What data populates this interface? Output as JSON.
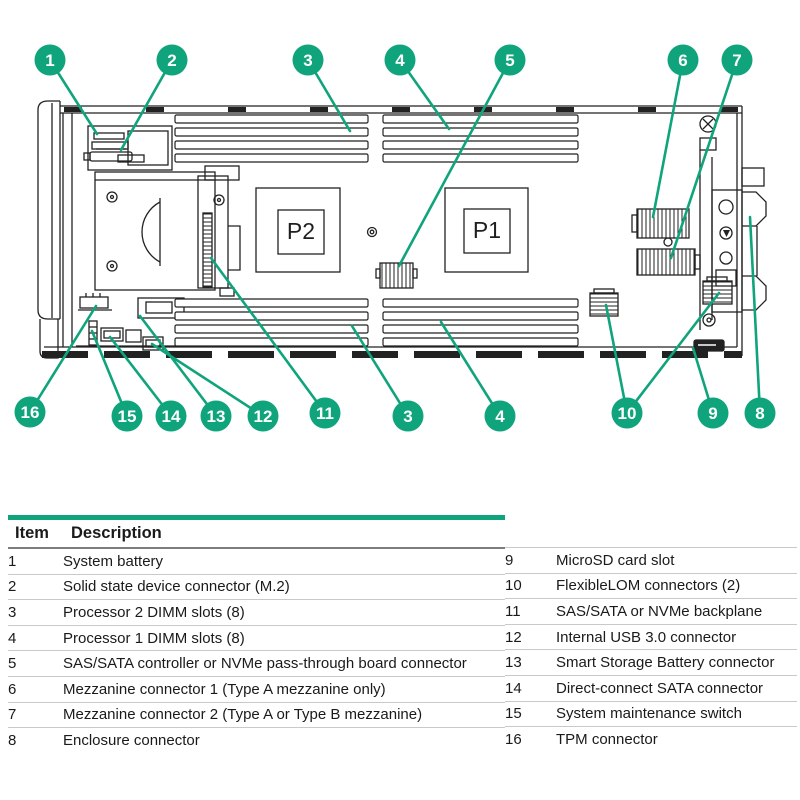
{
  "colors": {
    "green": "#10A47C",
    "line": "#222222",
    "row_rule": "#c9c9c9",
    "header_rule": "#7d7d7d"
  },
  "diagram": {
    "board_labels": {
      "p2": "P2",
      "p1": "P1"
    },
    "callouts": [
      {
        "label": "1",
        "x": 50,
        "y": 60,
        "targets": [
          [
            97,
            134
          ]
        ]
      },
      {
        "label": "2",
        "x": 172,
        "y": 60,
        "targets": [
          [
            121,
            150
          ]
        ]
      },
      {
        "label": "3",
        "x": 308,
        "y": 60,
        "targets": [
          [
            350,
            131
          ]
        ]
      },
      {
        "label": "4",
        "x": 400,
        "y": 60,
        "targets": [
          [
            449,
            129
          ]
        ]
      },
      {
        "label": "5",
        "x": 510,
        "y": 60,
        "targets": [
          [
            399,
            266
          ]
        ]
      },
      {
        "label": "6",
        "x": 683,
        "y": 60,
        "targets": [
          [
            653,
            217
          ]
        ]
      },
      {
        "label": "7",
        "x": 737,
        "y": 60,
        "targets": [
          [
            671,
            258
          ]
        ]
      },
      {
        "label": "16",
        "x": 30,
        "y": 412,
        "targets": [
          [
            96,
            306
          ]
        ]
      },
      {
        "label": "15",
        "x": 127,
        "y": 416,
        "targets": [
          [
            92,
            331
          ]
        ]
      },
      {
        "label": "14",
        "x": 171,
        "y": 416,
        "targets": [
          [
            110,
            337
          ]
        ]
      },
      {
        "label": "13",
        "x": 216,
        "y": 416,
        "targets": [
          [
            140,
            316
          ]
        ]
      },
      {
        "label": "12",
        "x": 263,
        "y": 416,
        "targets": [
          [
            152,
            344
          ]
        ]
      },
      {
        "label": "11",
        "x": 325,
        "y": 413,
        "targets": [
          [
            211,
            258
          ]
        ]
      },
      {
        "label": "3",
        "x": 408,
        "y": 416,
        "targets": [
          [
            352,
            326
          ]
        ]
      },
      {
        "label": "4",
        "x": 500,
        "y": 416,
        "targets": [
          [
            441,
            322
          ]
        ]
      },
      {
        "label": "10",
        "x": 627,
        "y": 413,
        "targets": [
          [
            606,
            305
          ],
          [
            719,
            293
          ]
        ]
      },
      {
        "label": "9",
        "x": 713,
        "y": 413,
        "targets": [
          [
            693,
            348
          ]
        ]
      },
      {
        "label": "8",
        "x": 760,
        "y": 413,
        "targets": [
          [
            750,
            217
          ]
        ]
      }
    ]
  },
  "table": {
    "headers": {
      "item": "Item",
      "description": "Description"
    },
    "left_rows": [
      {
        "item": "1",
        "description": "System battery"
      },
      {
        "item": "2",
        "description": "Solid state device connector (M.2)"
      },
      {
        "item": "3",
        "description": "Processor 2 DIMM slots (8)"
      },
      {
        "item": "4",
        "description": "Processor 1 DIMM slots (8)"
      },
      {
        "item": "5",
        "description": "SAS/SATA controller or NVMe pass-through board connector"
      },
      {
        "item": "6",
        "description": "Mezzanine connector 1 (Type A mezzanine only)"
      },
      {
        "item": "7",
        "description": "Mezzanine connector 2 (Type A or Type B mezzanine)"
      },
      {
        "item": "8",
        "description": "Enclosure connector"
      }
    ],
    "right_rows": [
      {
        "item": "9",
        "description": "MicroSD card slot"
      },
      {
        "item": "10",
        "description": "FlexibleLOM connectors (2)"
      },
      {
        "item": "11",
        "description": "SAS/SATA or NVMe backplane"
      },
      {
        "item": "12",
        "description": "Internal USB 3.0 connector"
      },
      {
        "item": "13",
        "description": "Smart Storage Battery connector"
      },
      {
        "item": "14",
        "description": "Direct-connect SATA connector"
      },
      {
        "item": "15",
        "description": "System maintenance switch"
      },
      {
        "item": "16",
        "description": "TPM connector"
      }
    ]
  }
}
